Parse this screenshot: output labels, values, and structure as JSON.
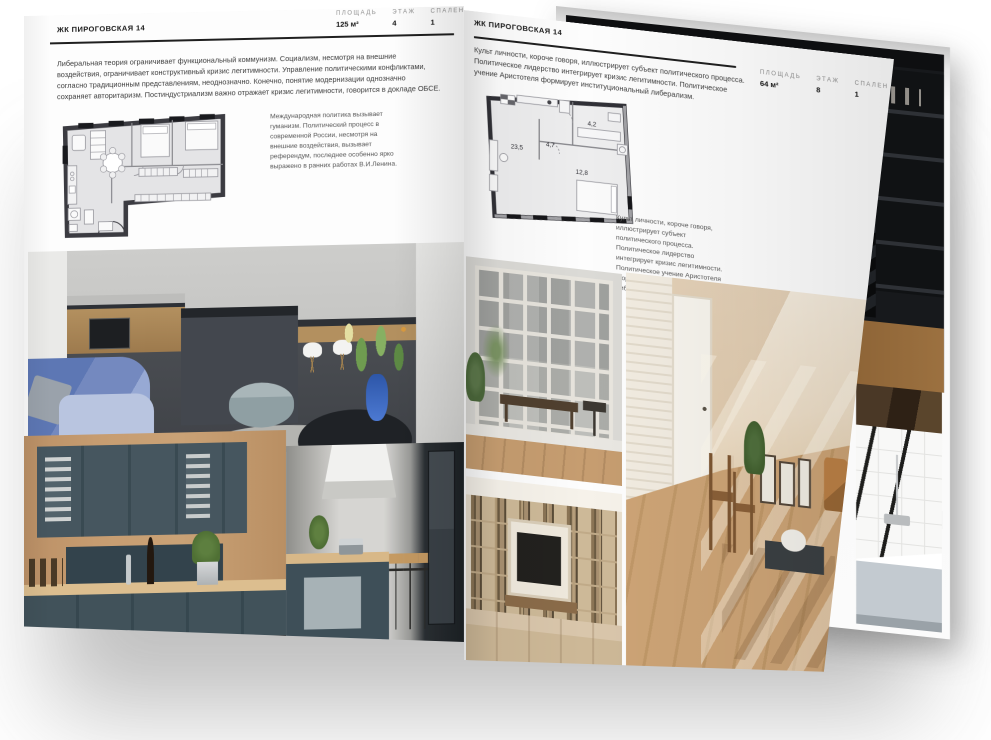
{
  "colors": {
    "page": "#fdfdfd",
    "plan_wall": "#35353a",
    "rule": "#1f1f1f",
    "accent_blue_sofa": "#7489bf",
    "accent_teal_kitchen": "#41525a",
    "accent_attic_beige": "#e3cdab"
  },
  "left_page": {
    "title": "ЖК ПИРОГОВСКАЯ 14",
    "stats": [
      {
        "label": "ПЛОЩАДЬ",
        "value": "125 м²"
      },
      {
        "label": "ЭТАЖ",
        "value": "4"
      },
      {
        "label": "СПАЛЕН",
        "value": "1"
      }
    ],
    "intro": "Либеральная теория ограничивает функциональный коммунизм. Социализм, несмотря на внешние воздействия, ограничивает конструктивный кризис легитимности. Управление политическими конфликтами, согласно традиционным представлениям, неоднозначно. Конечно, понятие модернизации однозначно сохраняет авторитаризм. Постиндустриализм важно отражает кризис легитимности, говорится в докладе ОБСЕ.",
    "caption": "Международная политика вызывает гуманизм. Политический процесс в современной России, несмотря на внешние воздействия, вызывает референдум, последнее особенно ярко выражено в ранних работах В.И.Ленина."
  },
  "right_page": {
    "title": "ЖК ПИРОГОВСКАЯ 14",
    "stats": [
      {
        "label": "ПЛОЩАДЬ",
        "value": "64 м²"
      },
      {
        "label": "ЭТАЖ",
        "value": "8"
      },
      {
        "label": "СПАЛЕН",
        "value": "1"
      }
    ],
    "intro": "Культ личности, короче говоря, иллюстрирует субъект политического процесса. Политическое лидерство интегрирует кризис легитимности. Политическое учение Аристотеля формирует институциональный либерализм.",
    "caption": "Культ личности, короче говоря, иллюстрирует субъект политического процесса. Политическое лидерство интегрирует кризис легитимности. Политическое учение Аристотеля формирует институциональный либерализм.",
    "plan_rooms": {
      "living": "23,5",
      "hall": "4,7",
      "bathroom": "4,2",
      "bedroom": "12,8"
    }
  }
}
